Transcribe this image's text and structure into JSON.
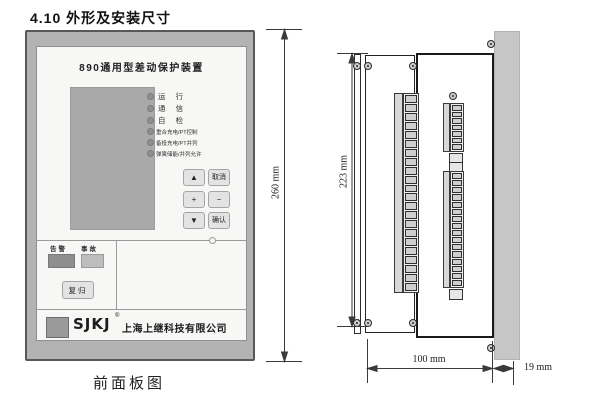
{
  "page": {
    "heading": "4.10 外形及安装尺寸",
    "caption_front_panel": "前面板图"
  },
  "front_panel": {
    "title": "890通用型差动保护装置",
    "status_leds": [
      "运 行",
      "通 信",
      "自 检"
    ],
    "function_leds": [
      "重合充电/PT控制",
      "备投充电/PT并列",
      "弹簧储能/并列允许"
    ],
    "keypad": {
      "up": "▲",
      "cancel": "取消",
      "plus": "+",
      "minus": "−",
      "down": "▼",
      "confirm": "确认"
    },
    "indicators": {
      "alarm": "告警",
      "fault": "事故"
    },
    "reset": "复归",
    "brand": {
      "logo": "SJKJ",
      "reg": "®",
      "company": "上海上继科技有限公司"
    }
  },
  "dimensions": {
    "panel_height": "260 mm",
    "case_height": "223 mm",
    "case_depth": "100 mm",
    "front_depth": "19 mm"
  },
  "colors": {
    "bezel": "#b3b3b3",
    "inner_panel": "#f7f7f6",
    "lcd": "#a9a9a9",
    "alarm_indicator": "#8e8e8e",
    "fault_indicator": "#bdbdbd",
    "mounting_panel": "#c6c6c6",
    "line": "#3a3a3a"
  }
}
